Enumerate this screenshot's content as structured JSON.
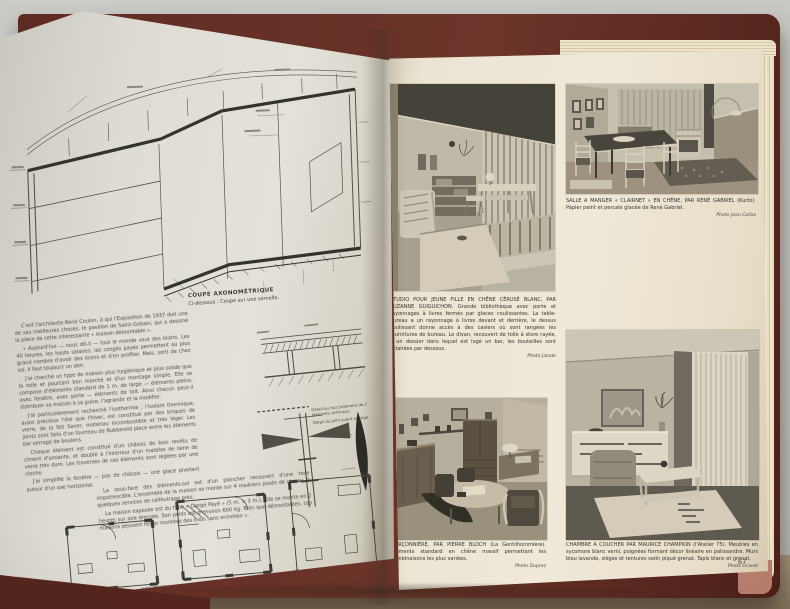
{
  "colors": {
    "background": "#c6c7c3",
    "table": "#a6937a",
    "cover": "#5e2b22",
    "left_page": "#dedcd5",
    "right_page": "#ece5d3",
    "ink": "#3e3d36"
  },
  "left_page": {
    "axo_caption_title": "COUPE AXONOMÉTRIQUE",
    "axo_caption_sub": "Ci-dessous : Coupe sur une semelle.",
    "paragraphs": [
      "C'est l'architecte René Coulon, à qui l'Exposition de 1937 doit une de ses meilleures choses, le pavillon de Saint-Gobain, qui a dessiné la pièce de cette intéressante « maison démontable ».",
      "« Aujourd'hui — nous dit-il — tout le monde veut des loisirs. Les 40 heures, les hauts salaires, les congés payés permettent au plus grand nombre d'avoir des loisirs et d'en profiter. Mais, sorti de chez soi, il faut toujours un abri.",
      "J'ai cherché un type de maison plus hygiénique et plus solide que la toile et pourtant bon marché et d'un montage simple. Elle se compose d'éléments standard de 1 m. de large — éléments pleins, avec fenêtre, avec porte — éléments de toit. Ainsi chacun peut-il distribuer sa maison à sa guise, l'agrandir et la modifier.",
      "J'ai particulièrement recherché l'isothermie ; l'isolant thermique, aussi précieux l'été que l'hiver, est constitué par des briques de verre, de la Sté Saver, matériau incombustible et très léger. Les joints sont faits d'un fourreau de Rubberoïd placé entre les éléments par serrage de boulons.",
      "Chaque élément est constitué d'un châssis de bois revêtu de ciment d'amiante, et doublé à l'intérieur d'un matelas de laine de verre très dure. Les traverses de ces éléments sont réglées par une cloche.",
      "J'ai simplifié la fenêtre — pas de châssis — une glace pivotant autour d'un axe horizontal.",
      "La sous-face des éléments-sol est d'un plancher recouvert d'une toile imputrescible. L'ensemble de la maison se monte sur 4 madriers posés de niveau, à quelques services de calfeutrage près.",
      "La maison exposée est du type « Congé Payé » (5 m. × 3 m.). Elle se monte en 2 heures sur aire dressée. Son poids est d'environ 600 kg. Bien que démontables, ces maisons peuvent rester montées des mois sans entretien »."
    ],
    "detail_label_1": "Détail du raccordement de 2 éléments verticaux.",
    "detail_label_2": "Détail du joint avant serrage.",
    "plans_caption": "LES MÊMES ÉLÉMENTS « STANDARD » (voir photos p. 6)"
  },
  "right_page": {
    "photos": [
      {
        "caption": "STUDIO POUR JEUNE FILLE EN CHÊNE CÉRUSÉ BLANC, PAR SUZANNE GUIGUICHON. Grande bibliothèque avec porte et rayonnages à livres fermés par glaces coulissantes. La table-bureau a un rayonnage à livres devant et derrière, le dessus coulissant donne accès à des casiers où sont rangées les fournitures de bureau. Le divan, recouvert de toile à store rayée, a un dossier dans lequel est logé un bar, les bouteilles sont éclairées par dessous.",
        "credit": "Photo Jalade"
      },
      {
        "caption": "SALLE A MANGER « CLAIRNET » EN CHÊNE, PAR RENÉ GABRIEL (Kurto). Papier peint et percale glacée de René Gabriel.",
        "credit": "Photo Jean Collas"
      },
      {
        "caption": "GARÇONNIÈRE, PAR PIERRE BLOCH (La Gentilhommière). Éléments standard en chêne massif permettant les combinaisons les plus variées.",
        "credit": "Photo Duprez"
      },
      {
        "caption": "CHAMBRE A COUCHER PAR MAURICE CHAMPION (l'Atelier 75). Meubles en sycomore blanc verni, poignées formant décor linéaire en palissandre. Murs bleu lavande, sièges et tentures satin piqué grenat. Tapis blanc et grenat.",
        "credit": "Photo Gravot"
      }
    ],
    "page_number": "67"
  }
}
